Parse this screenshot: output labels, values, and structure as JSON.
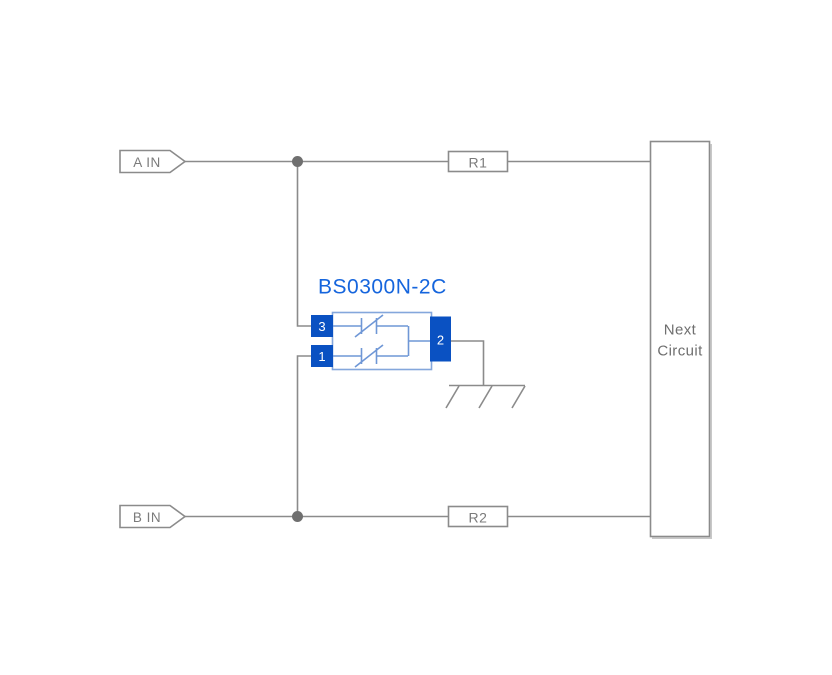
{
  "colors": {
    "wire": "#8b8b8b",
    "junction": "#6f6f6f",
    "pin-blue": "#0a51c2",
    "title-blue": "#1565dd",
    "body-blue": "#84a7dc",
    "inner-blue": "#6f97d6",
    "label-gray": "#7b7b7b",
    "background": "#ffffff"
  },
  "diagram": {
    "component": {
      "title": "BS0300N-2C",
      "pin_top_left": "3",
      "pin_bottom_left": "1",
      "pin_right": "2"
    },
    "terminals": {
      "a": "A IN",
      "b": "B IN"
    },
    "resistors": {
      "r1": "R1",
      "r2": "R2"
    },
    "next_circuit": {
      "line1": "Next",
      "line2": "Circuit"
    }
  }
}
